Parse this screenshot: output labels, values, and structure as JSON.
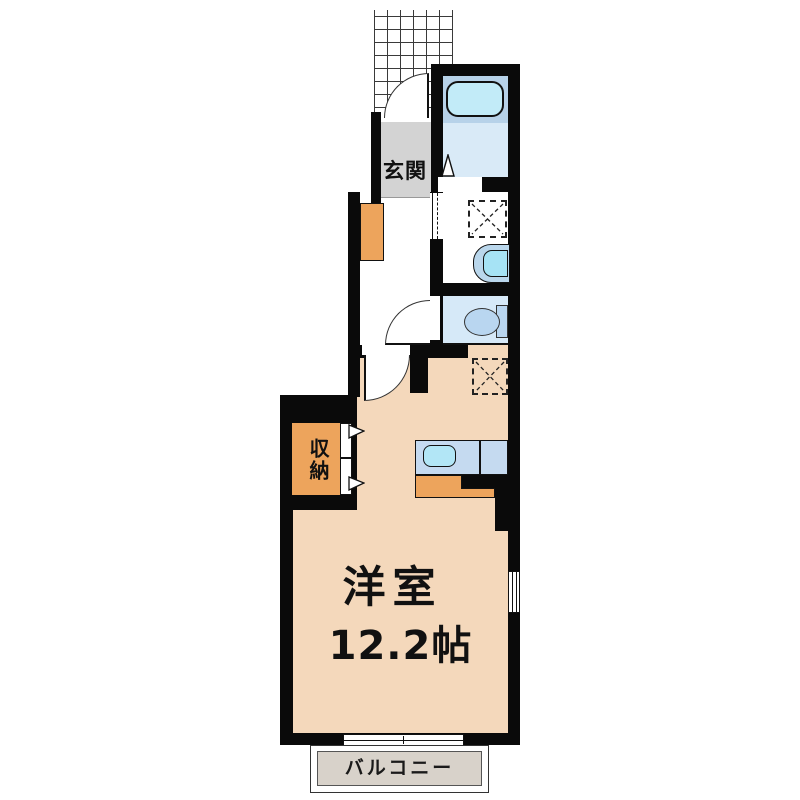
{
  "floorplan": {
    "labels": {
      "genkan": "玄関",
      "closet": "収納",
      "main_room_name": "洋室",
      "main_room_size": "12.2帖",
      "balcony": "バルコニー"
    },
    "fixtures": {
      "bathtub": "bathtub",
      "washing_machine_space": "washing-machine-space-dashed-x",
      "washbasin": "washbasin",
      "toilet": "toilet",
      "refrigerator_space": "refrigerator-space-dashed-x",
      "kitchen_sink": "kitchen-sink",
      "shoe_cabinet": "shoe-cabinet",
      "entrance_porch": "tiled-porch-grid"
    },
    "colors": {
      "wall": "#0a0a0a",
      "floor-tan": "#f4d8bb",
      "accent-orange": "#eda45c",
      "genkan-gray": "#d3d3d3",
      "balcony-gray": "#d8d2ca",
      "bath-floor": "#d9eaf7",
      "bath-band": "#b7d2e9",
      "tub": "#c2ebf8",
      "counter-blue": "#c5daf0",
      "sink-cyan": "#b2e6f6",
      "basin-outer": "#bad7ec",
      "basin-bowl": "#a6e3f5",
      "toilet-floor": "#d6e9f8",
      "fixture-blue": "#b9d6f0"
    }
  }
}
